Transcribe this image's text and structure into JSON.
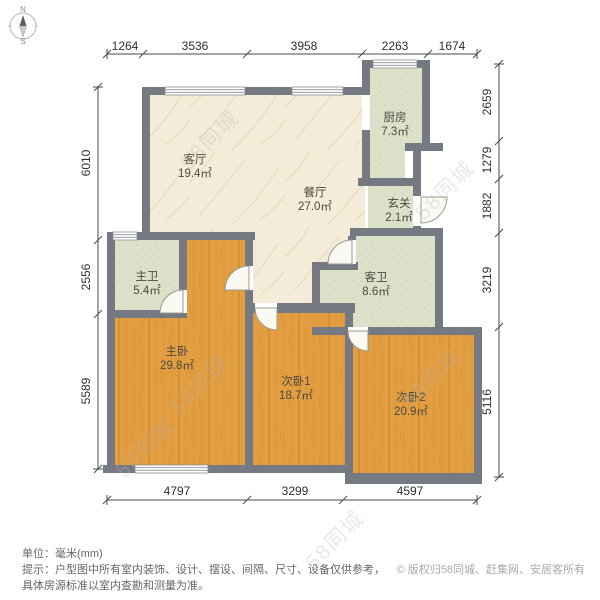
{
  "compass": {
    "north": "N",
    "south": "S"
  },
  "watermark": {
    "text": "58同城"
  },
  "rooms": [
    {
      "name": "客厅",
      "area": "19.4㎡"
    },
    {
      "name": "餐厅",
      "area": "27.0㎡"
    },
    {
      "name": "厨房",
      "area": "7.3㎡"
    },
    {
      "name": "玄关",
      "area": "2.1㎡"
    },
    {
      "name": "主卫",
      "area": "5.4㎡"
    },
    {
      "name": "客卫",
      "area": "8.6㎡"
    },
    {
      "name": "主卧",
      "area": "29.8㎡"
    },
    {
      "name": "次卧1",
      "area": "18.7㎡"
    },
    {
      "name": "次卧2",
      "area": "20.9㎡"
    }
  ],
  "dimensions": {
    "unit": "mm",
    "top": [
      "1264",
      "3536",
      "3958",
      "2263",
      "1674"
    ],
    "left": [
      "6010",
      "2556",
      "5589"
    ],
    "right": [
      "2659",
      "1279",
      "1882",
      "3219",
      "5116"
    ],
    "bottom": [
      "4797",
      "3299",
      "4597"
    ]
  },
  "footer": {
    "unit_line": "单位：毫米(mm)",
    "tip_line1": "提示：户型图中所有室内装饰、设计、摆设、间隔、尺寸、设备仅供参考，",
    "tip_line2": "具体房源标准以室内查勘和测量为准。",
    "copyright": "© 版权归58同城、赶集网、安居客所有"
  },
  "colors": {
    "wall": "#757a82",
    "wood_floor": "#e29e41",
    "tile_floor": "#dde1ca",
    "marble_floor": "#f4ecd8"
  }
}
